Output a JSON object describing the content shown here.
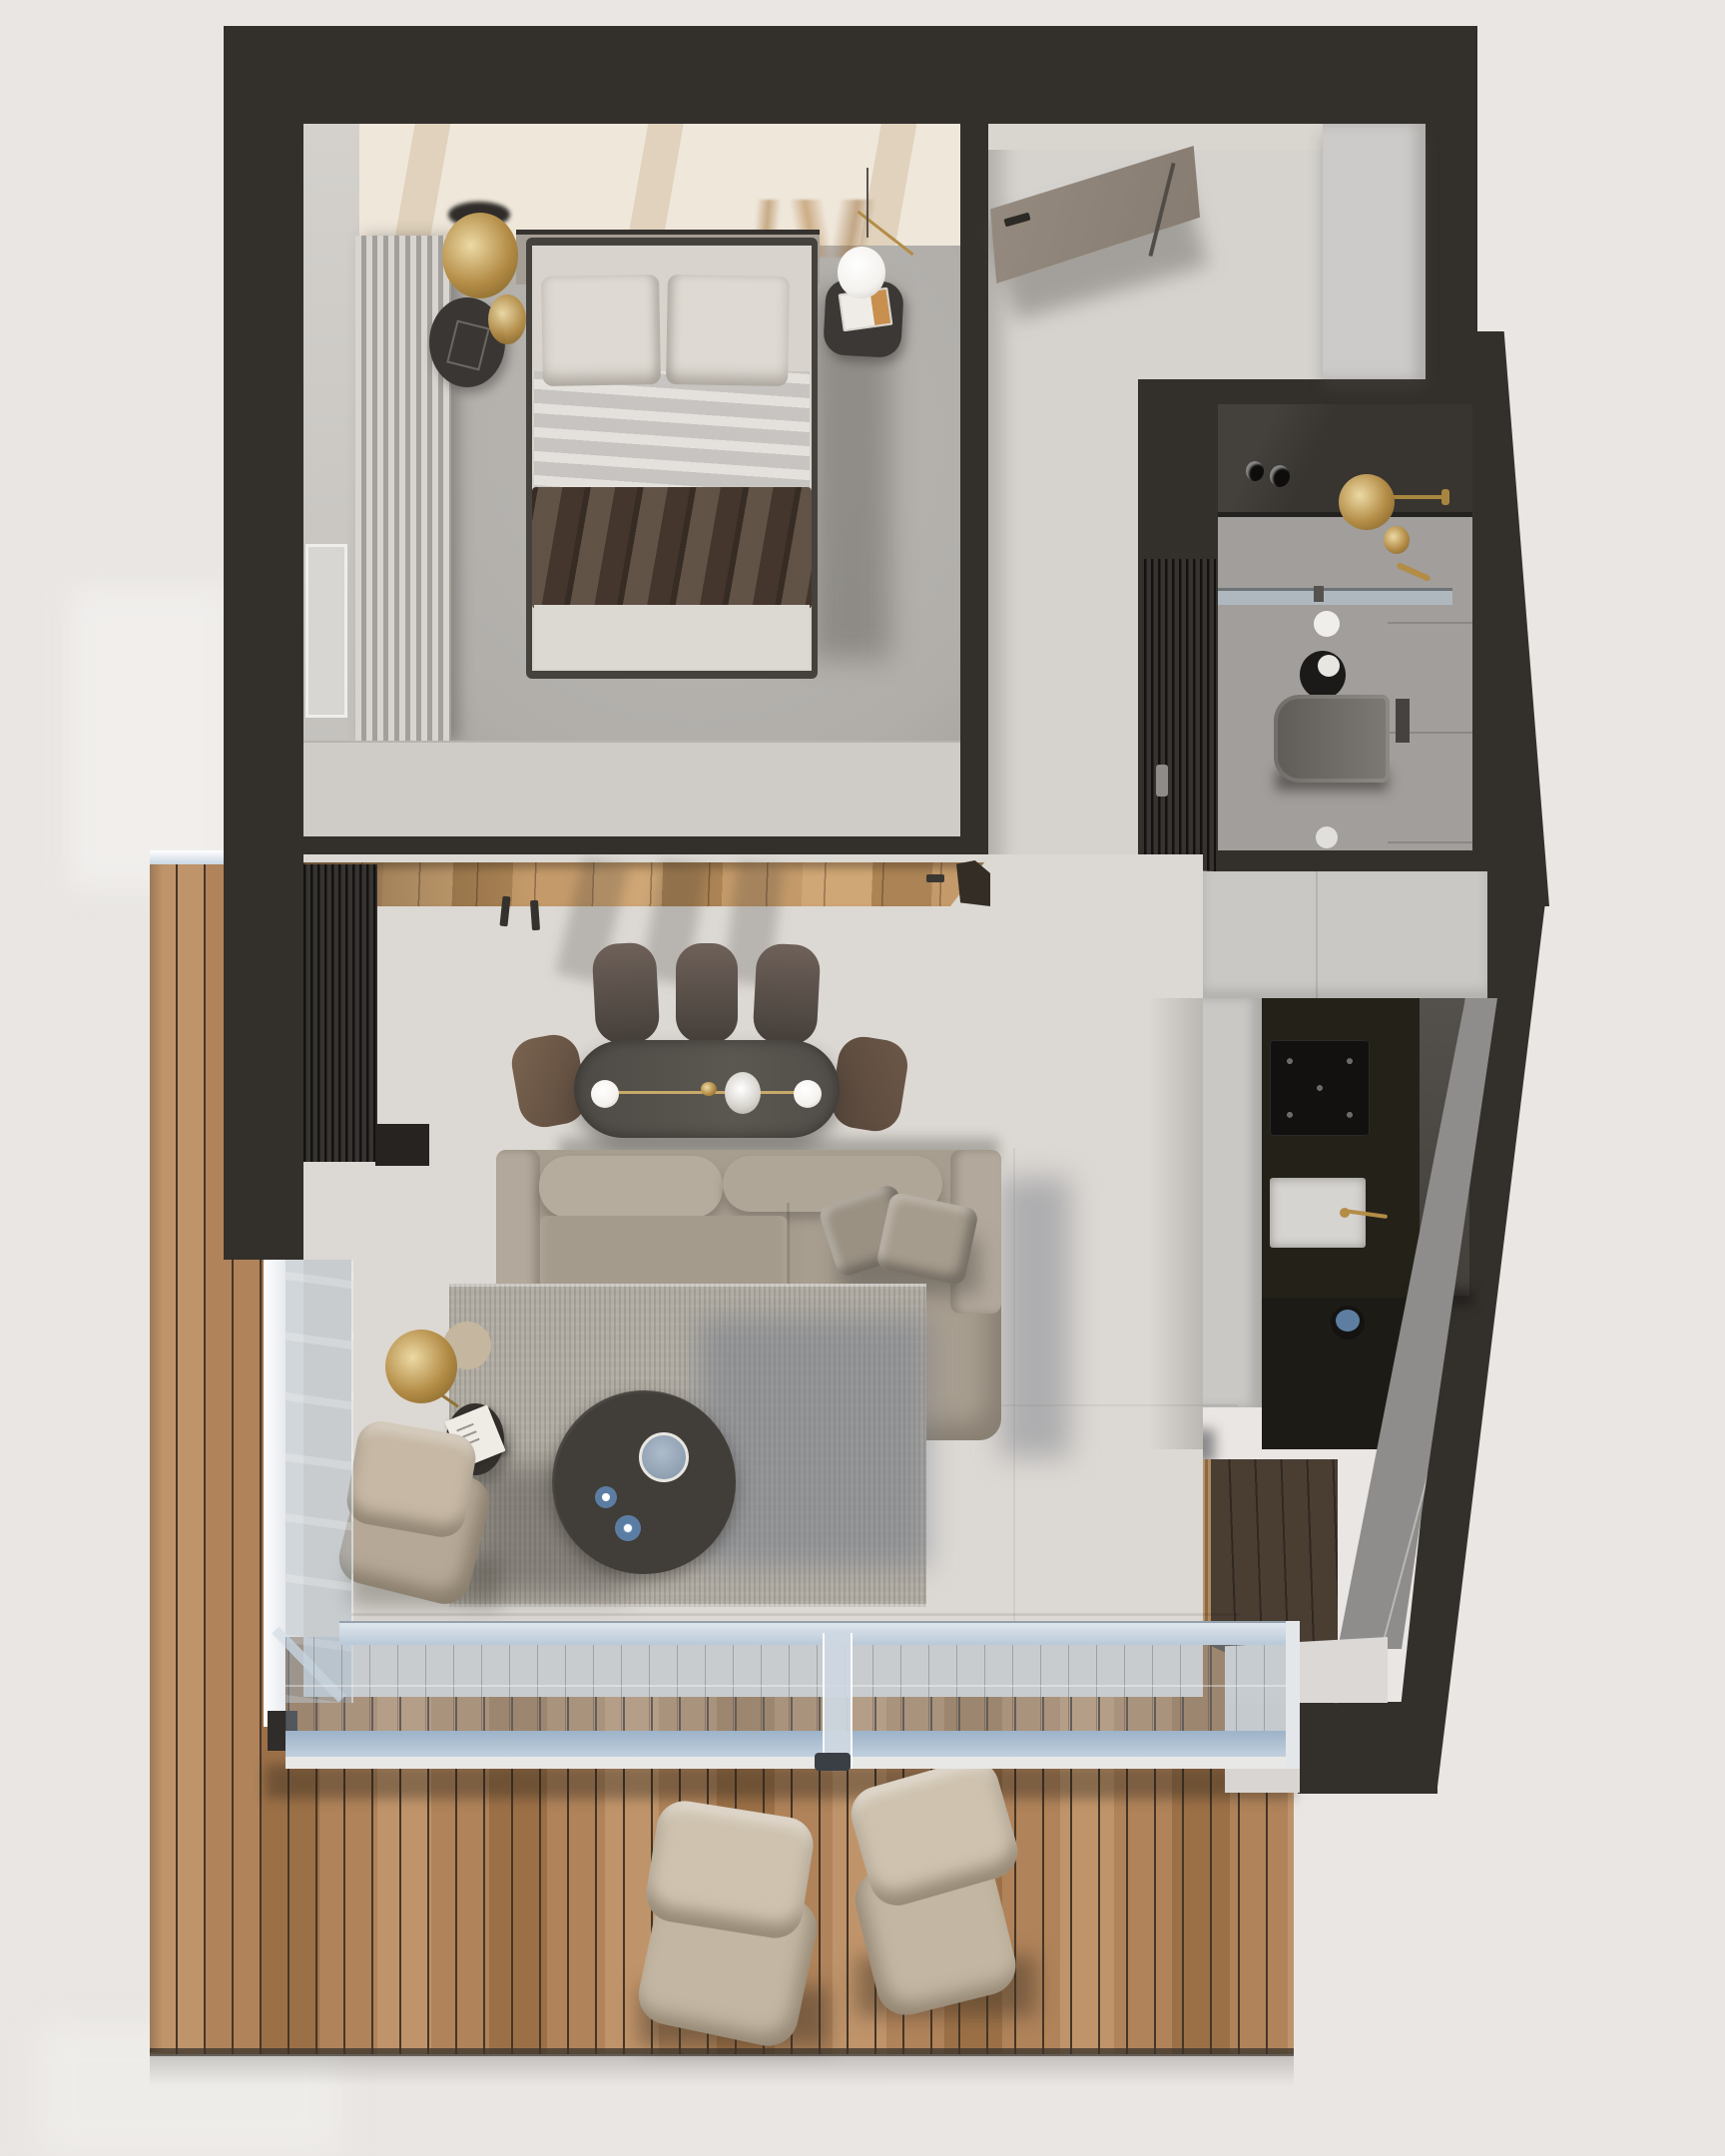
{
  "meta": {
    "description": "Top-down 3D architectural render (dollhouse floor-plan view) of a small studio apartment with bedroom, bathroom, kitchen, living-dining room and wooden terrace",
    "view": "top-down",
    "visible_text": []
  },
  "rooms": [
    {
      "id": "bedroom",
      "name": "bedroom",
      "furniture": [
        "double-bed",
        "white-pillows",
        "brown-throw-blanket",
        "nightstand-left",
        "gold-pendant-lamp",
        "gold-tray",
        "nightstand-right",
        "sphere-table-lamp",
        "magazine",
        "curtain-wardrobe",
        "window",
        "dried-plant"
      ]
    },
    {
      "id": "hallway",
      "name": "entry-hall",
      "furniture": [
        "entry-door",
        "white-closet"
      ]
    },
    {
      "id": "bathroom",
      "name": "bathroom",
      "furniture": [
        "dark-vanity",
        "gold-rain-shower",
        "gold-valve",
        "glass-partition",
        "wall-hung-toilet",
        "flush-plate",
        "toilet-paper-holder",
        "floor-drain",
        "slatted-dark-door"
      ]
    },
    {
      "id": "kitchen",
      "name": "kitchen",
      "furniture": [
        "white-cabinet-run",
        "black-counter",
        "induction-cooktop",
        "sink",
        "gold-faucet",
        "tall-dark-cabinet",
        "marble-backsplash",
        "pot"
      ]
    },
    {
      "id": "living_dining",
      "name": "living-dining-room",
      "furniture": [
        "wood-floor-strip",
        "coat-hooks",
        "slat-panel",
        "dining-table",
        "dining-chairs-x5",
        "table-light-with-glass-balls",
        "centerpiece-bowl",
        "l-shaped-sofa",
        "sofa-pillows-x2",
        "area-rug",
        "round-coffee-table",
        "serving-bowl",
        "blue-cups-x2",
        "gold-floor-lamp",
        "beige-side-table",
        "black-side-table",
        "book",
        "lounge-floor-cushion"
      ]
    },
    {
      "id": "stairs",
      "name": "staircase",
      "furniture": [
        "light-wood-steps-x4",
        "dark-wood-landing",
        "white-threshold"
      ]
    },
    {
      "id": "terrace",
      "name": "terrace-deck",
      "furniture": [
        "bean-bag-left",
        "bean-bag-right",
        "glass-sliding-wall",
        "glass-balustrade"
      ]
    }
  ],
  "counts": {
    "dining_chairs": 5,
    "bean_bags": 2,
    "stair_steps": 4,
    "sofa_pillows": 2,
    "bed_pillows": 2
  },
  "colors": {
    "bg": "#e9e6e3",
    "wall": "#33302c",
    "bedroom_floor": "#b1aeaa",
    "bedroom_floor_dk": "#9d9a96",
    "bedroom_ceiling": "#efe7da",
    "ceiling_streak": "#e0d2bc",
    "plant": "#a4783f",
    "wall_white": "#cfccc8",
    "curtain_a": "#d8d5d0",
    "curtain_b": "#a3a09c",
    "headboard": "#a49e95",
    "bed_frame": "#45423e",
    "mattress": "#d8d4cd",
    "pillow": "#ded9d2",
    "sheet_a": "#d2d3d7",
    "sheet_b": "#b9bcc3",
    "blanket": "#554437",
    "bed_foot": "#dcd8d2",
    "nightstand": "#393633",
    "gold": "#b38c46",
    "gold_light": "#ecd9a4",
    "lamp_white": "#f4f2ee",
    "hall_floor": "#d6d3cf",
    "door_taupe": "#8d8277",
    "closet_white": "#cdcbc9",
    "bath_floor": "#a19e9b",
    "bath_wall": "#a6a4a1",
    "bath_dark": "#38342f",
    "glass_metal": "#6e7377",
    "toilet_a": "#5f5b56",
    "toilet_b": "#7d7974",
    "slat_dark": "#2b2825",
    "kitchen_white": "#cac8c5",
    "counter_black": "#242119",
    "counter_black_dk": "#1d1b16",
    "cooktop": "#121110",
    "sink_white": "#d6d4d1",
    "cab_gray_a": "#54504c",
    "cab_gray_b": "#433f3b",
    "marble_light": "#8f8d8b",
    "marble_vein": "#b9b7b5",
    "stairs_wood": "#b9946a",
    "stairs_wood_dk": "#8a6a47",
    "stairs_wood_hi": "#b28a5e",
    "landing_wood": "#4a3e33",
    "threshold": "#dbd8d5",
    "deck_a": "#b0835a",
    "deck_b": "#c0946a",
    "deck_c": "#9c7047",
    "deck_gap": "#453627",
    "interior_wood": "#c49a6a",
    "interior_wood_hi": "#cfa675",
    "interior_wood_dk": "#ab8354",
    "glass_frame": "#e6e9ec",
    "glass_rail_a": "#9db3c8",
    "glass_rail_b": "#c3d2e0",
    "glass_tint": "rgba(160,180,200,0.32)",
    "living_floor": "#dcd8d3",
    "rug": "#b2ada4",
    "sofa": "#a89e90",
    "sofa_light": "#b2a89b",
    "sofa_cushion": "#b6ac9e",
    "sofa_seat": "#a59b8d",
    "sofa_pillow": "#9a9183",
    "chair_top": "#6e6159",
    "chair_bottom": "#453f3a",
    "chair_brown_l": "#7a6350",
    "chair_brown_r": "#6d5848",
    "table_dark": "#514d48",
    "coffee_table": "#413d39",
    "bowl_blue_a": "#aebccb",
    "bowl_blue_b": "#8194a6",
    "cup_blue": "#6d93c0",
    "bean_bag": "#c3b7a3",
    "bean_bag_light": "#cfc3b0"
  }
}
